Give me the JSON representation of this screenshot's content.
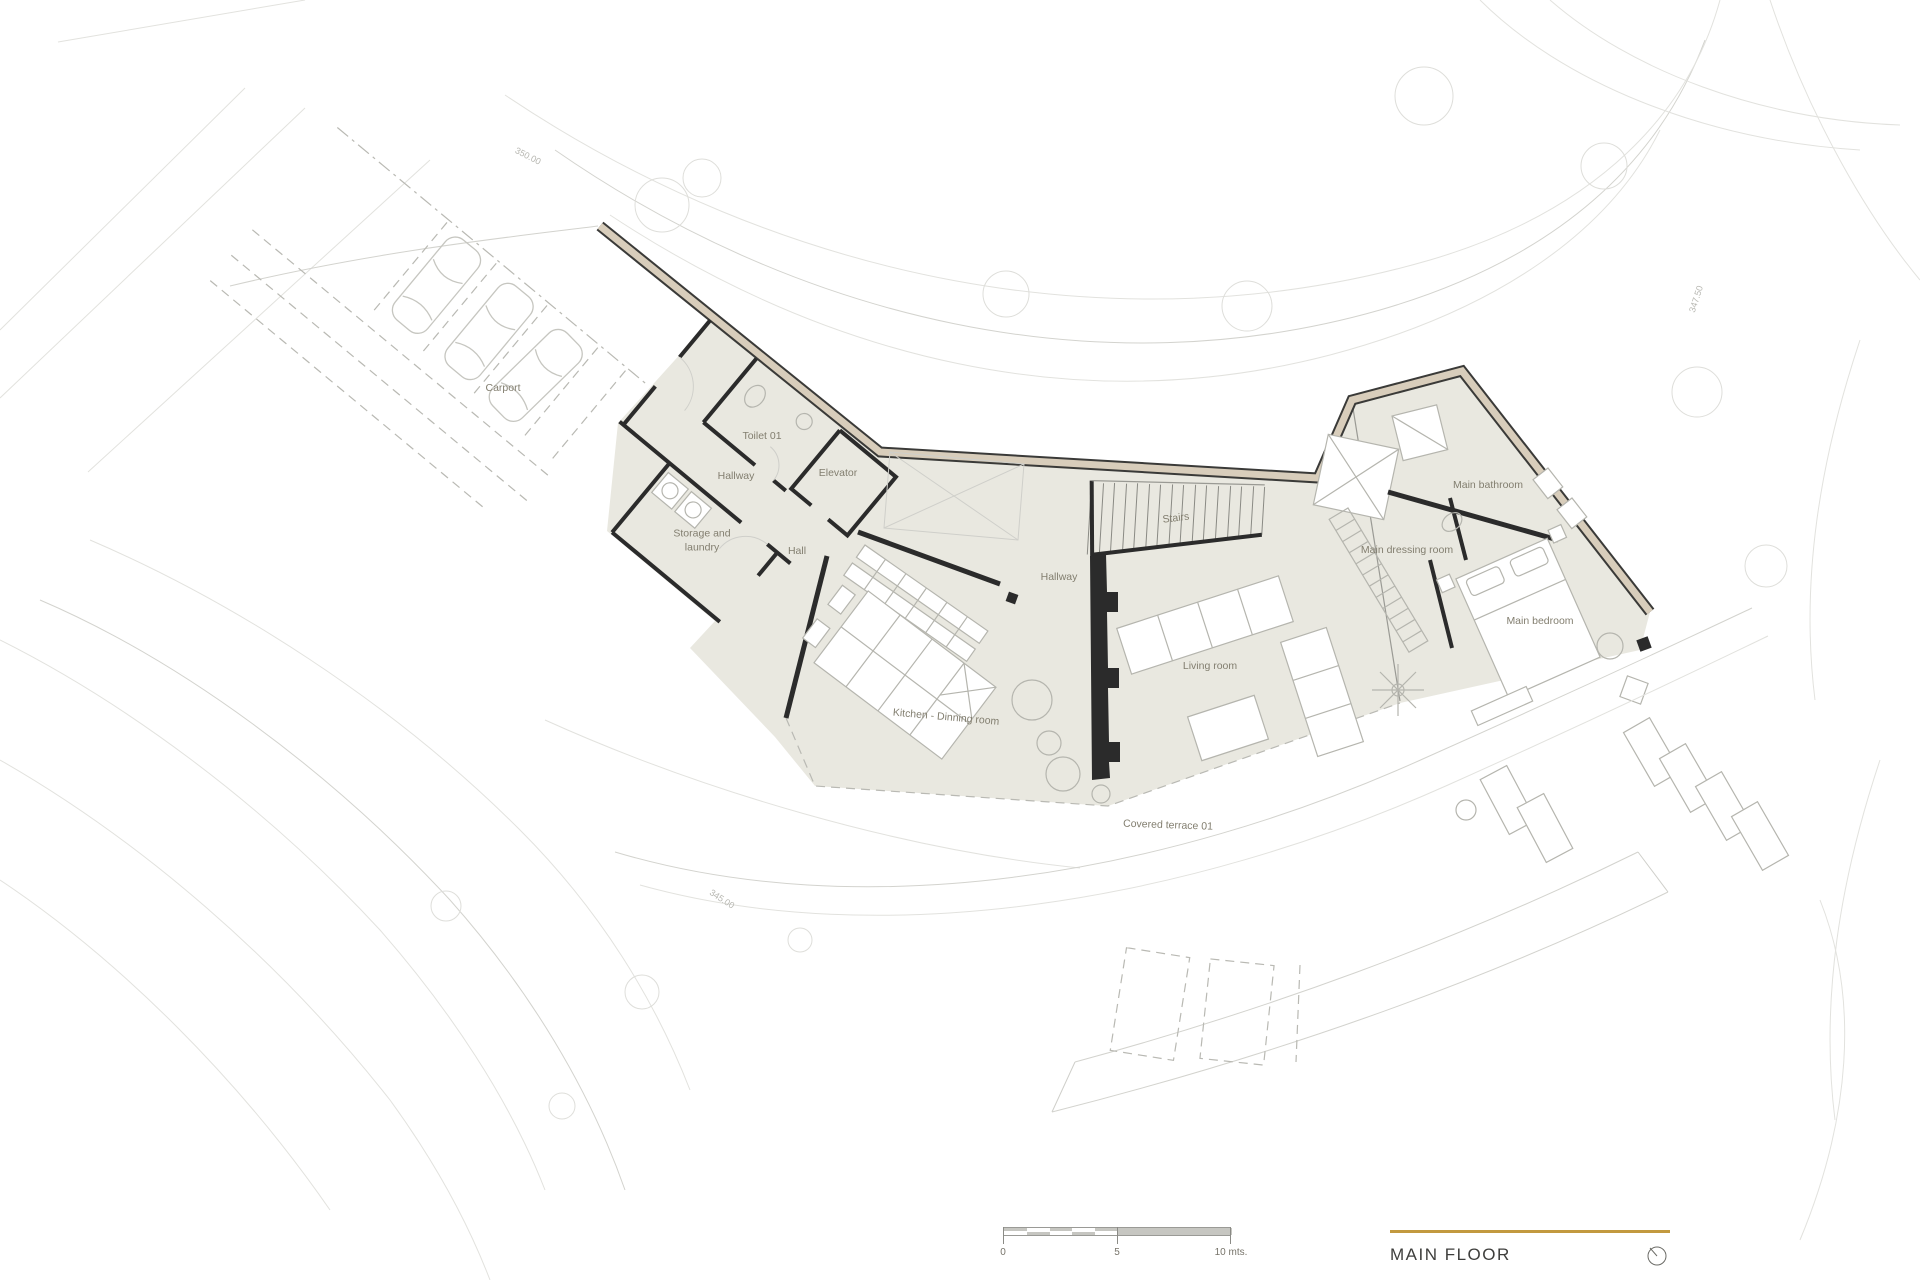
{
  "page": {
    "width": 1920,
    "height": 1280,
    "background": "#ffffff"
  },
  "title_block": {
    "title": "MAIN FLOOR",
    "rule_color": "#c2993f",
    "compass_icon": "compass-icon"
  },
  "scale_bar": {
    "px_length": 228,
    "meters_total": 10,
    "meters_split": 5,
    "labels": [
      {
        "text": "0",
        "offset": 0
      },
      {
        "text": "5",
        "offset": 114
      },
      {
        "text": "10 mts.",
        "offset": 228
      }
    ]
  },
  "rooms": [
    {
      "id": "carport",
      "name": "Carport",
      "x": 503,
      "y": 389,
      "rotation": 0
    },
    {
      "id": "toilet-01",
      "name": "Toilet 01",
      "x": 762,
      "y": 437,
      "rotation": 0
    },
    {
      "id": "hallway-entry",
      "name": "Hallway",
      "x": 736,
      "y": 477,
      "rotation": 0
    },
    {
      "id": "elevator",
      "name": "Elevator",
      "x": 838,
      "y": 474,
      "rotation": 0
    },
    {
      "id": "storage-laundry",
      "name": "Storage and laundry",
      "x": 702,
      "y": 541,
      "rotation": 0,
      "wrap": true,
      "maxWidth": 82
    },
    {
      "id": "hall",
      "name": "Hall",
      "x": 797,
      "y": 552,
      "rotation": 0
    },
    {
      "id": "stairs",
      "name": "Stairs",
      "x": 1176,
      "y": 519,
      "rotation": -7
    },
    {
      "id": "hallway-main",
      "name": "Hallway",
      "x": 1059,
      "y": 578,
      "rotation": 0
    },
    {
      "id": "kitchen-dining",
      "name": "Kitchen - Dinning room",
      "x": 946,
      "y": 718,
      "rotation": 5
    },
    {
      "id": "living-room",
      "name": "Living room",
      "x": 1210,
      "y": 667,
      "rotation": 0
    },
    {
      "id": "main-bathroom",
      "name": "Main bathroom",
      "x": 1488,
      "y": 486,
      "rotation": 0
    },
    {
      "id": "main-dressing-room",
      "name": "Main dressing room",
      "x": 1407,
      "y": 551,
      "rotation": 0
    },
    {
      "id": "main-bedroom",
      "name": "Main bedroom",
      "x": 1540,
      "y": 622,
      "rotation": 0
    },
    {
      "id": "covered-terrace-01",
      "name": "Covered terrace 01",
      "x": 1168,
      "y": 826,
      "rotation": 2
    }
  ],
  "site": {
    "contour_labels": [
      {
        "id": "elevation-350",
        "text": "350.00",
        "x": 528,
        "y": 156,
        "rotation": 27
      },
      {
        "id": "elevation-345",
        "text": "345.00",
        "x": 722,
        "y": 899,
        "rotation": 33
      },
      {
        "id": "elevation-347-50",
        "text": "347.50",
        "x": 1696,
        "y": 299,
        "rotation": -72
      }
    ]
  },
  "colors": {
    "floor_fill": "#e9e8e0",
    "exterior_wall_fill": "#d8cdbb",
    "wall_line": "#2b2b2b",
    "contour_line": "#e2e2de",
    "furniture_line": "#b5b5ae",
    "room_label_text": "#827e6f",
    "contour_label_text": "#b7b7b1",
    "title_text": "#3e3e3c",
    "accent_gold": "#c2993f"
  }
}
